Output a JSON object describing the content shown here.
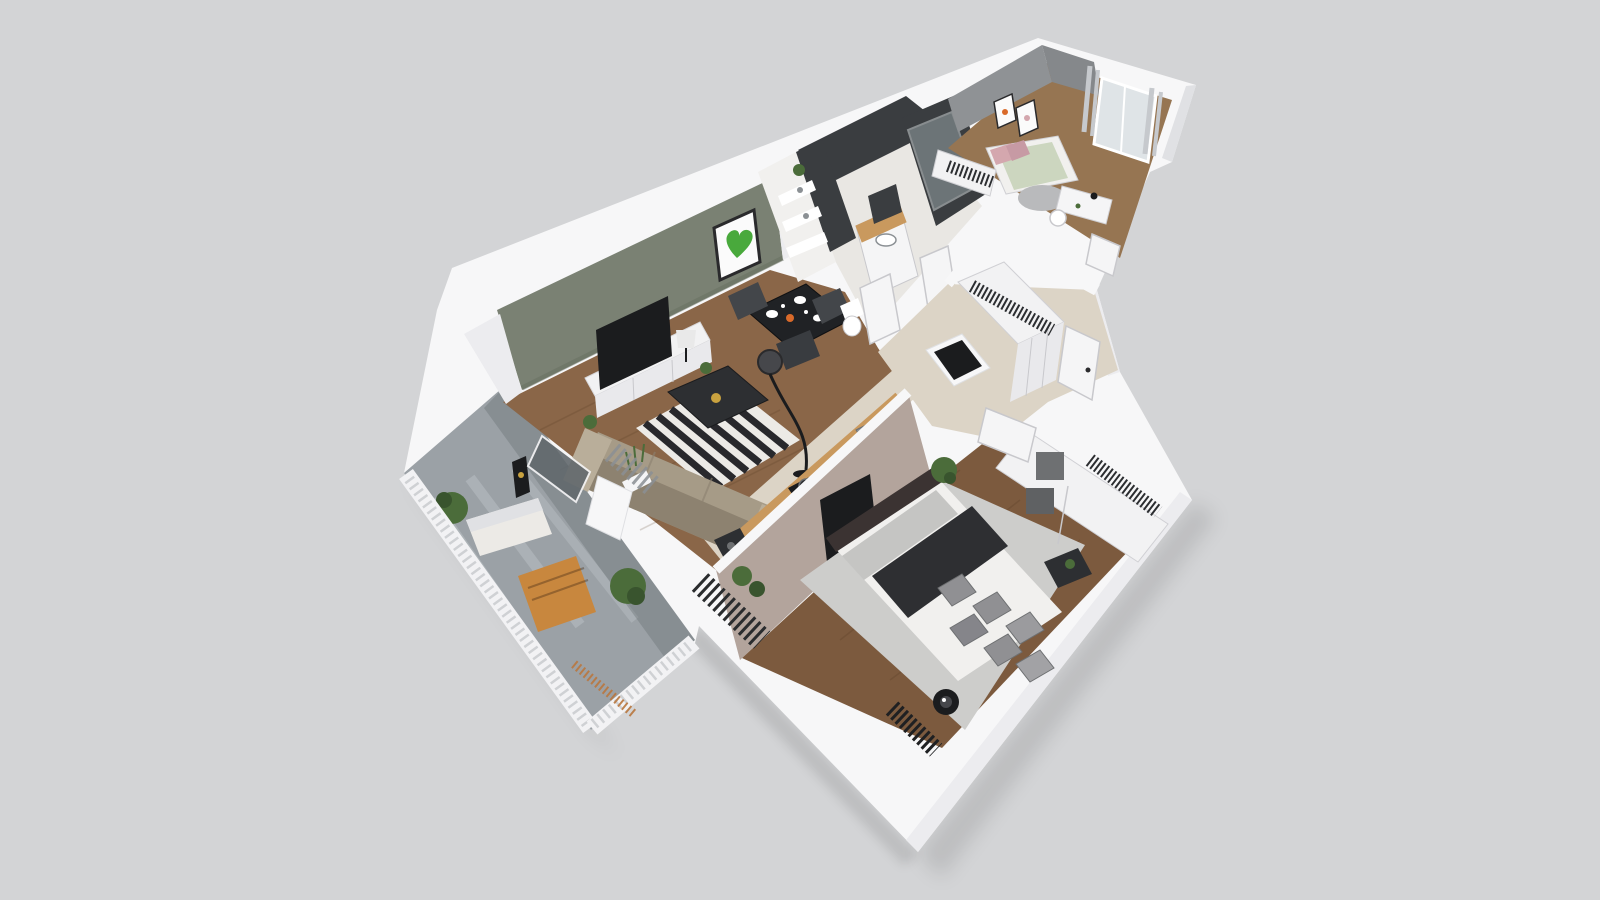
{
  "scene": {
    "kind": "3d-floor-plan-render",
    "style": "dollhouse isometric cutaway of a one-bedroom apartment, viewed from above at an angle",
    "width_px": 1600,
    "height_px": 900,
    "background": "#d3d4d6"
  },
  "colors": {
    "bg": "#d3d4d6",
    "shadow": "rgba(0,0,0,0.10)",
    "wallWhite": "#f7f7f8",
    "wallSide": "#ececef",
    "wallShade": "#e0e1e4",
    "greenWall": "#7a8173",
    "greenWallDark": "#687060",
    "grayWall": "#8f9295",
    "grayWallDark": "#85888b",
    "taupeWall": "#b3a49c",
    "darkTile": "#3a3d40",
    "subwayTile": "#f1f0ee",
    "glass": "#aab7bb",
    "glassDark": "#62696d",
    "woodLiving": "#8a6648",
    "woodBedroom": "#7c5a3e",
    "woodSmall": "#967552",
    "plankLine": "#4a3018",
    "tileBeige": "#dcd4c6",
    "balconyTile": "#9ba1a6",
    "balconyTileLight": "#bcc2c6",
    "rugWhite": "#eceae6",
    "rugBlack": "#28282c",
    "bedroomRug": "#cdcdcb",
    "sofa": "#a69b87",
    "sofaDark": "#8d8270",
    "cushion": "#b9ae9a",
    "coffeeTable": "#2d2f32",
    "diningTable": "#202225",
    "chairDark": "#43464a",
    "chairDarker": "#393c40",
    "black": "#1b1c1e",
    "lampShadeDark": "#46474b",
    "counterWood": "#c9995e",
    "tableWood": "#c8873e",
    "slatWood": "#b9773f",
    "bedWhite": "#f1f0ee",
    "sheetGray": "#c5c5c3",
    "pillowGray": "#909093",
    "throwDark": "#2e2f32",
    "headboard": "#3b3332",
    "wardrobeWhite": "#f2f2f3",
    "wardrobeFace": "#e9e9ec",
    "clothesDark": "#2c2e31",
    "boxGray": "#6e7072",
    "plantGreen": "#4b6c3a",
    "plantDark": "#39542e",
    "heartGreen": "#49a93c",
    "frameDark": "#2a2a2c",
    "artWhite": "#fbfbfb",
    "pinkBed": "#d4a7ae",
    "duvetGreen": "#ccd6bf",
    "curtain": "#c6c9cd",
    "doorWhite": "#f5f5f6",
    "doorEdge": "#c8c8cc",
    "handleDark": "#2b2b2d",
    "white": "#ffffff",
    "sinkGray": "#8b9094",
    "gold": "#c9a23f",
    "orange": "#d96a2a"
  },
  "rooms": [
    {
      "name": "living-room",
      "accent": "sage green feature wall with moss-heart wall art",
      "furniture": [
        "tv",
        "tv-sideboard",
        "table-lamp",
        "striped-rug",
        "coffee-table",
        "sofa",
        "dining-table",
        "dining-chairs",
        "arc-floor-lamp",
        "floor-speaker",
        "grass-planter",
        "balcony-slider"
      ]
    },
    {
      "name": "kitchen",
      "furniture": [
        "wood-counter",
        "cooktop-with-pots",
        "sink",
        "ventilation-shaft"
      ]
    },
    {
      "name": "bathroom",
      "accent": "charcoal tile and white subway tile",
      "furniture": [
        "shelf-unit-with-towels",
        "vanity-sink-wood-top",
        "mirror",
        "shower-glass",
        "small-sink",
        "double-doors"
      ]
    },
    {
      "name": "hallway",
      "furniture": [
        "built-in-wardrobe-with-clothes",
        "entrance-door",
        "tiled-floor"
      ]
    },
    {
      "name": "small-bedroom",
      "accent": "gray walls",
      "furniture": [
        "single-bed-pink-green",
        "wall-frames",
        "window-with-curtains",
        "desk",
        "chair",
        "round-rug",
        "open-closet"
      ]
    },
    {
      "name": "main-bedroom",
      "accent": "taupe wall with mounted tv",
      "furniture": [
        "double-bed",
        "gray-pillows",
        "dark-throw",
        "area-rug",
        "sliding-wardrobe",
        "storage-boxes",
        "side-table",
        "floor-lamp",
        "radiator",
        "slat-screen",
        "plants"
      ]
    },
    {
      "name": "balcony",
      "furniture": [
        "white-railing",
        "wood-table",
        "bench",
        "potted-plants",
        "lantern"
      ]
    }
  ]
}
